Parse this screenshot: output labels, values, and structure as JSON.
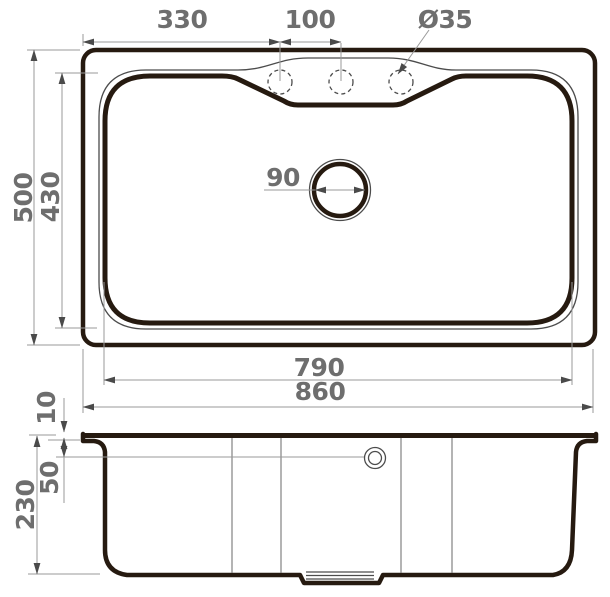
{
  "colors": {
    "outline": "#261a10",
    "thin_line": "#4c4c4c",
    "dimension_line": "#9a9a9a",
    "dimension_text": "#6e6e6e",
    "background": "#ffffff"
  },
  "top_view": {
    "dim_faucet_offset": "330",
    "dim_faucet_spacing": "100",
    "dim_faucet_hole_diameter": "Ø35",
    "dim_overall_depth": "500",
    "dim_bowl_depth": "430",
    "dim_drain_diameter": "90",
    "dim_bowl_width": "790",
    "dim_overall_width": "860"
  },
  "section_view": {
    "dim_rim_lip_height": "10",
    "dim_overflow_offset": "50",
    "dim_bowl_height": "230"
  }
}
